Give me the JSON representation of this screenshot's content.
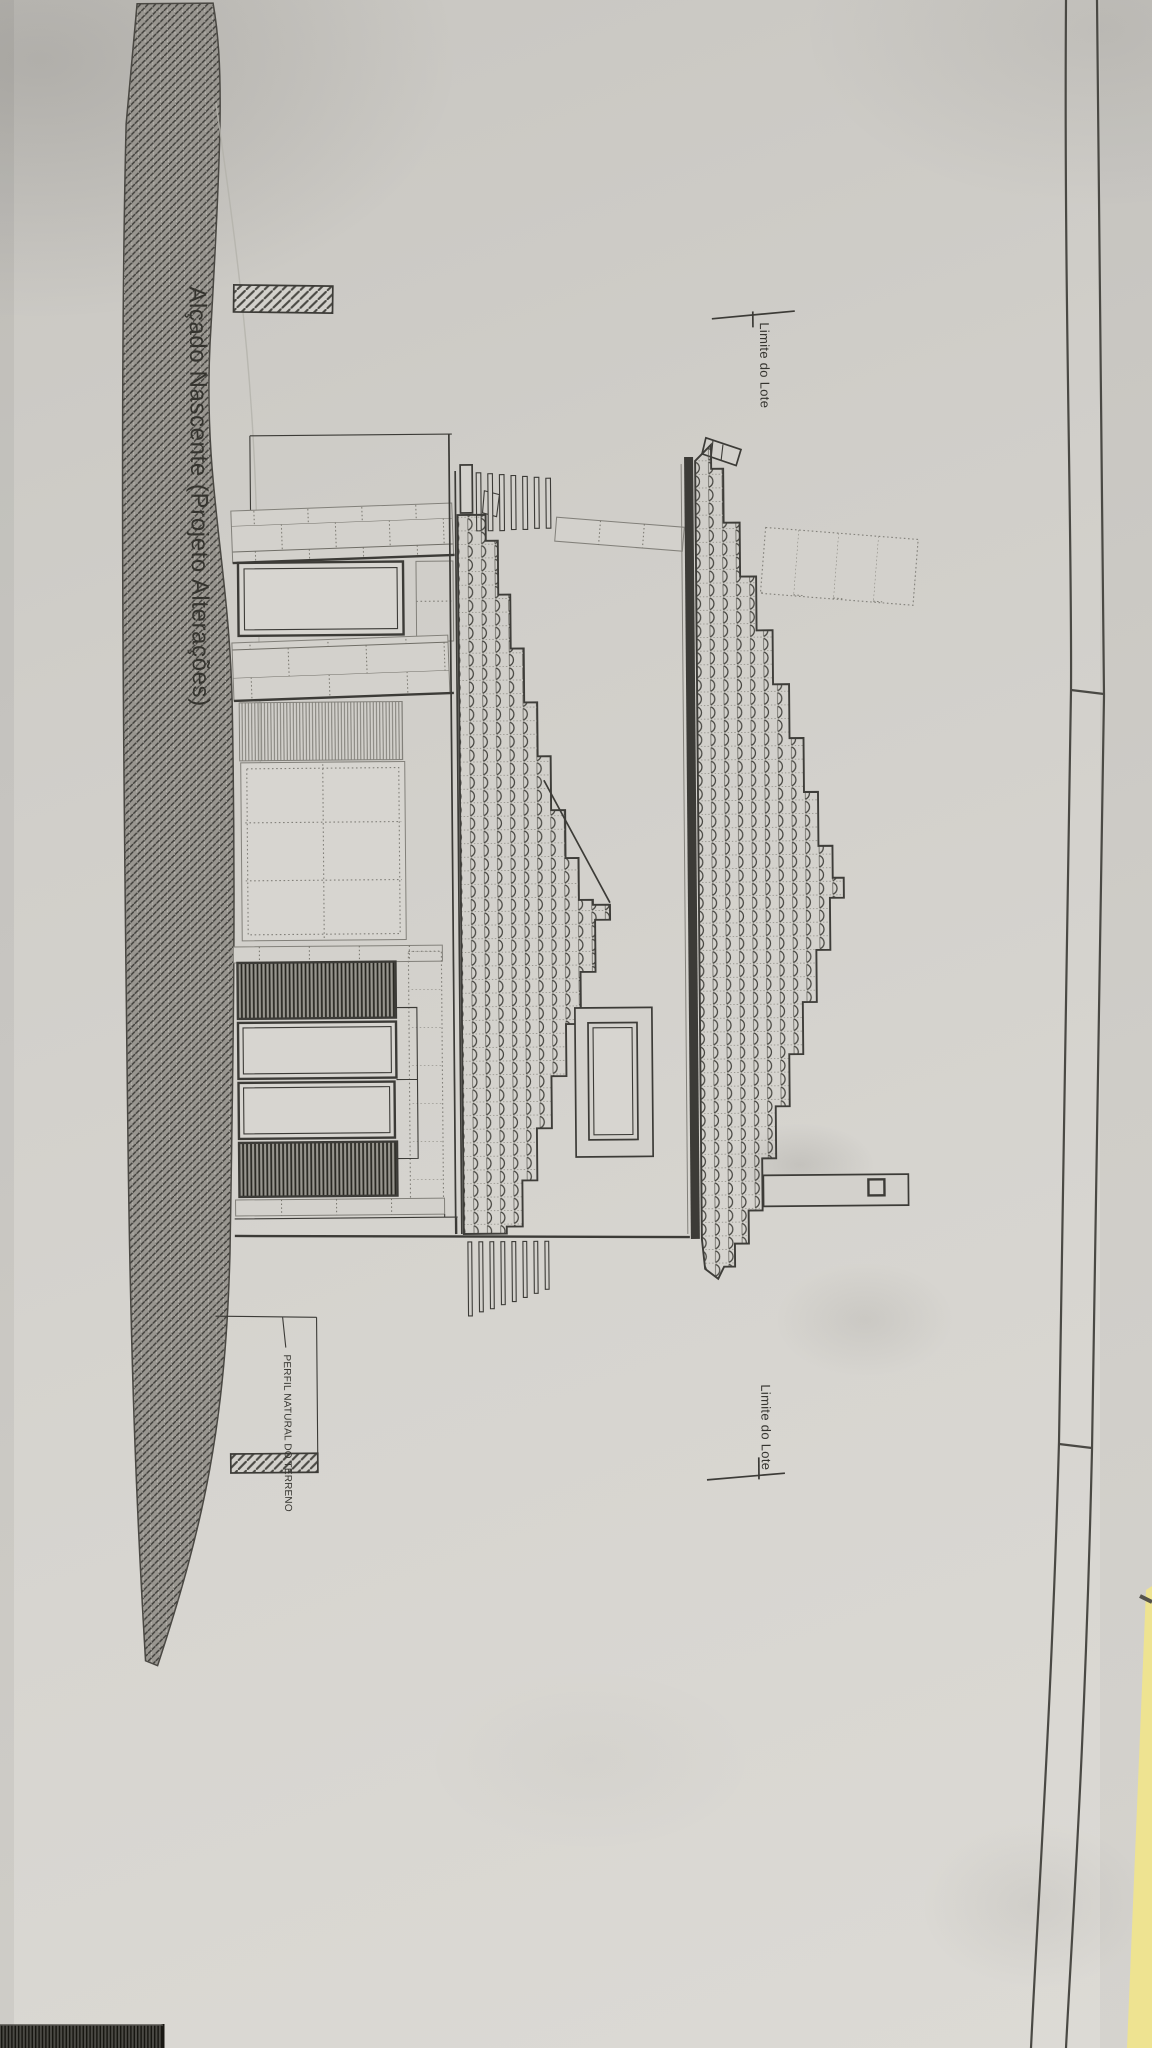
{
  "photo": {
    "description": "Photograph of a printed architectural elevation drawing sheet lying on a surface, rotated 90 degrees, with a yellow folder edge visible at the bottom-right corner",
    "sheet_title": "Alçado Nascente (Projeto Alterações)",
    "annotations": {
      "lot_limit_upper": "Limite do Lote",
      "lot_limit_lower": "Limite do Lote",
      "terrain_profile": "PERFIL NATURAL DO TERRENO"
    }
  },
  "colors": {
    "paper": "#d3d1cc",
    "paper_light": "#dddbd6",
    "paper_dark": "#c6c4bf",
    "ink": "#3c3b37",
    "ink_light": "#82807a",
    "hatch_fill": "#999690",
    "yellow_folder": "#eee391",
    "dark_edge_band": "#3a3936"
  }
}
